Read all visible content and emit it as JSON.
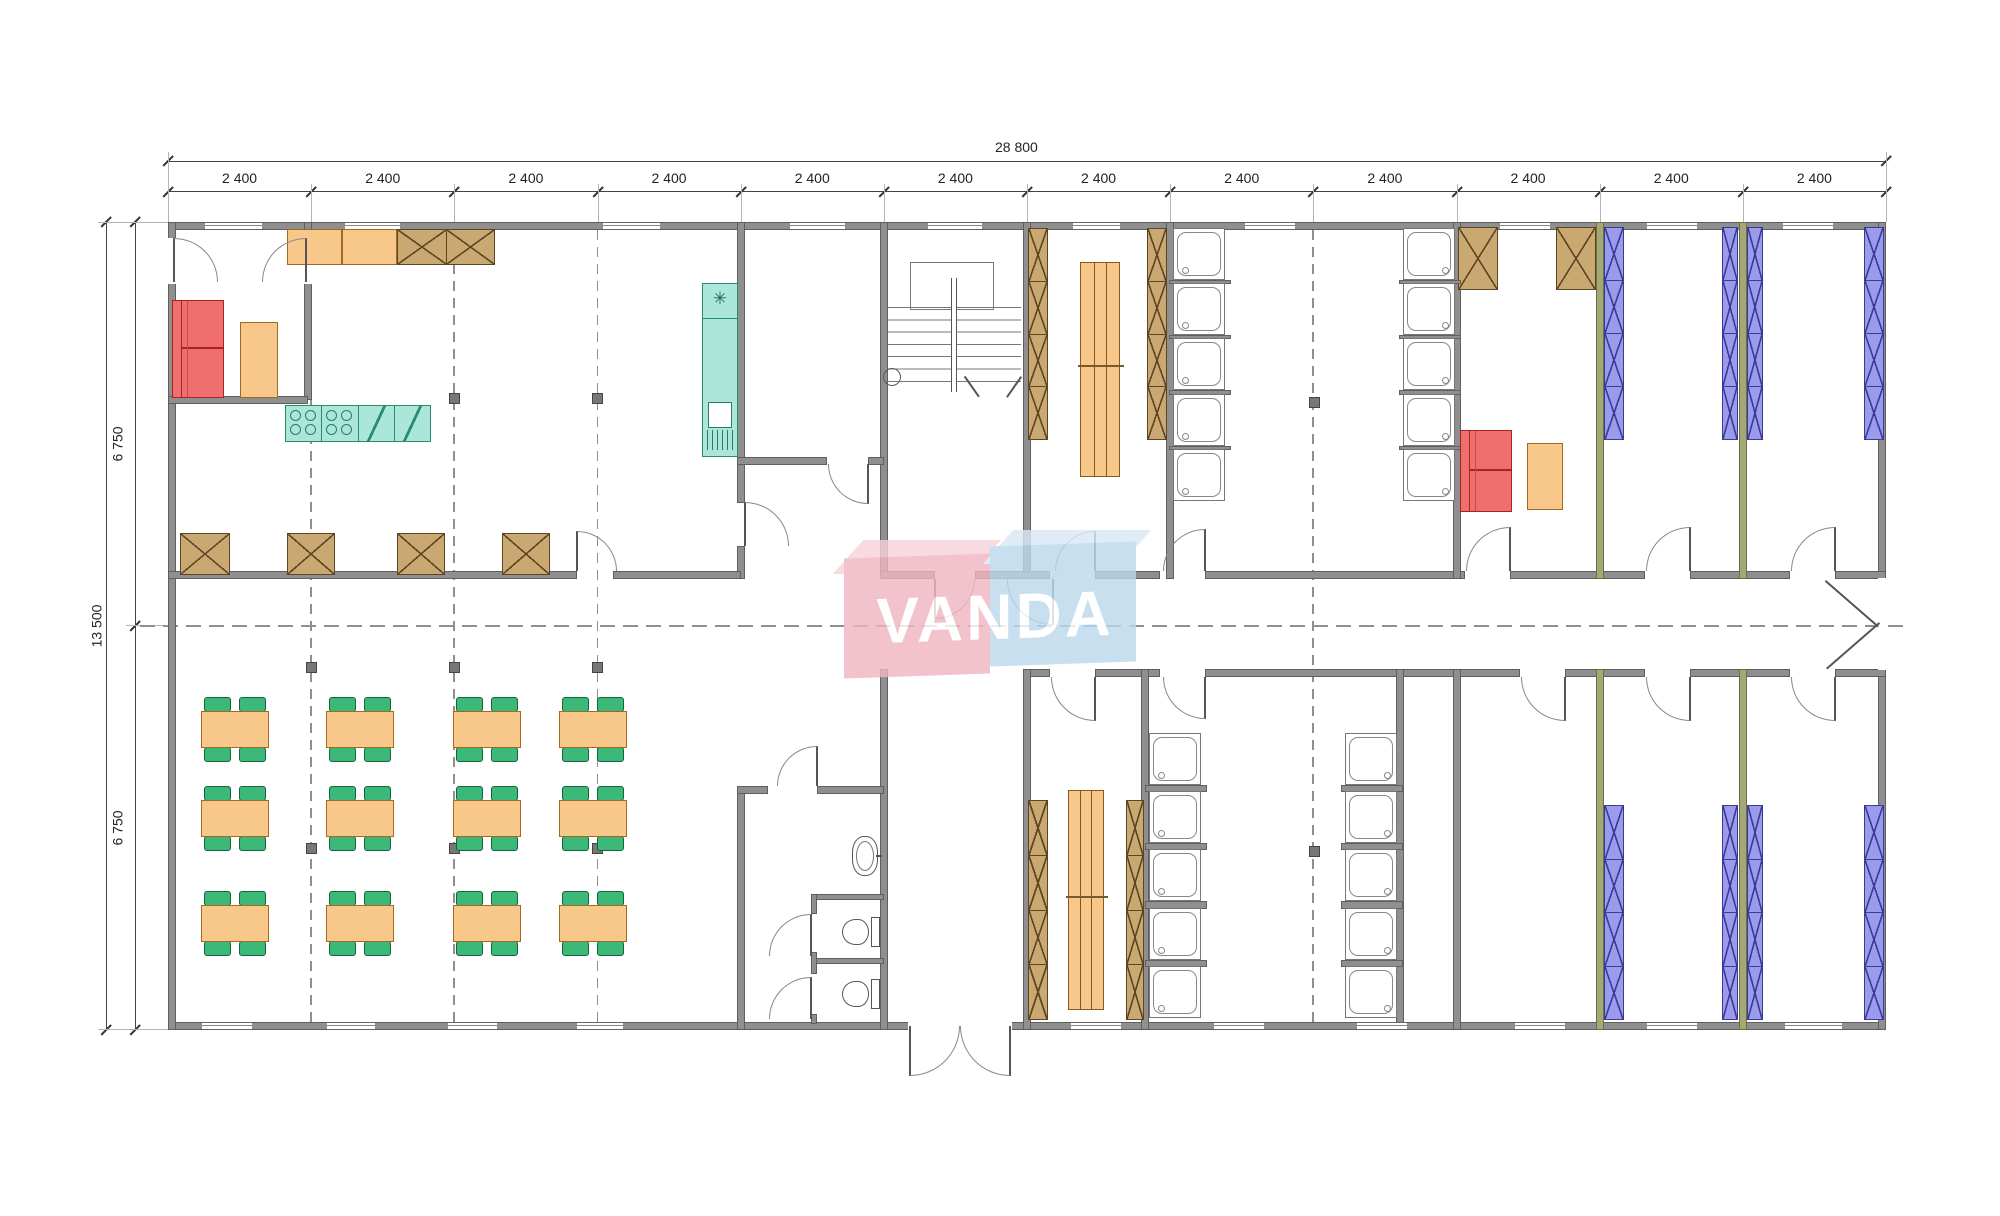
{
  "drawing": {
    "type": "floor-plan",
    "overall_width_label": "28 800",
    "overall_height_label": "13 500",
    "top_bay_labels": [
      "2 400",
      "2 400",
      "2 400",
      "2 400",
      "2 400",
      "2 400",
      "2 400",
      "2 400",
      "2 400",
      "2 400",
      "2 400",
      "2 400"
    ],
    "left_segment_labels": [
      "6 750",
      "6 750"
    ]
  },
  "watermark": {
    "text": "VANDA"
  },
  "palette": {
    "wall": "#8f8f8f",
    "wall_olive": "#a3a876",
    "furniture_orange": "#f8c88b",
    "wood_brown": "#c9a871",
    "chair_green": "#3cb878",
    "sofa_red": "#ef6f6f",
    "kitchen_teal": "#abe7d9",
    "bunk_blue": "#9b9bec",
    "watermark_pink": "#f0b6c3",
    "watermark_pink_top": "#f7d2da",
    "watermark_blue": "#bdd8ec",
    "watermark_blue_top": "#d8e9f6",
    "dim_text": "#222222"
  },
  "counts": {
    "dining_tables": 12,
    "chairs_per_table": 4,
    "shower_columns": 4,
    "stalls_per_shower_column": 5,
    "bunk_columns": 8,
    "bunk_sections_per_column": 4,
    "locker_columns": 6,
    "wardrobe_boxes": 4,
    "top_wall_cabinet_x_boxes": 2,
    "toilets": 2,
    "washbasins": 1,
    "kitchen_island_sections": 4
  }
}
